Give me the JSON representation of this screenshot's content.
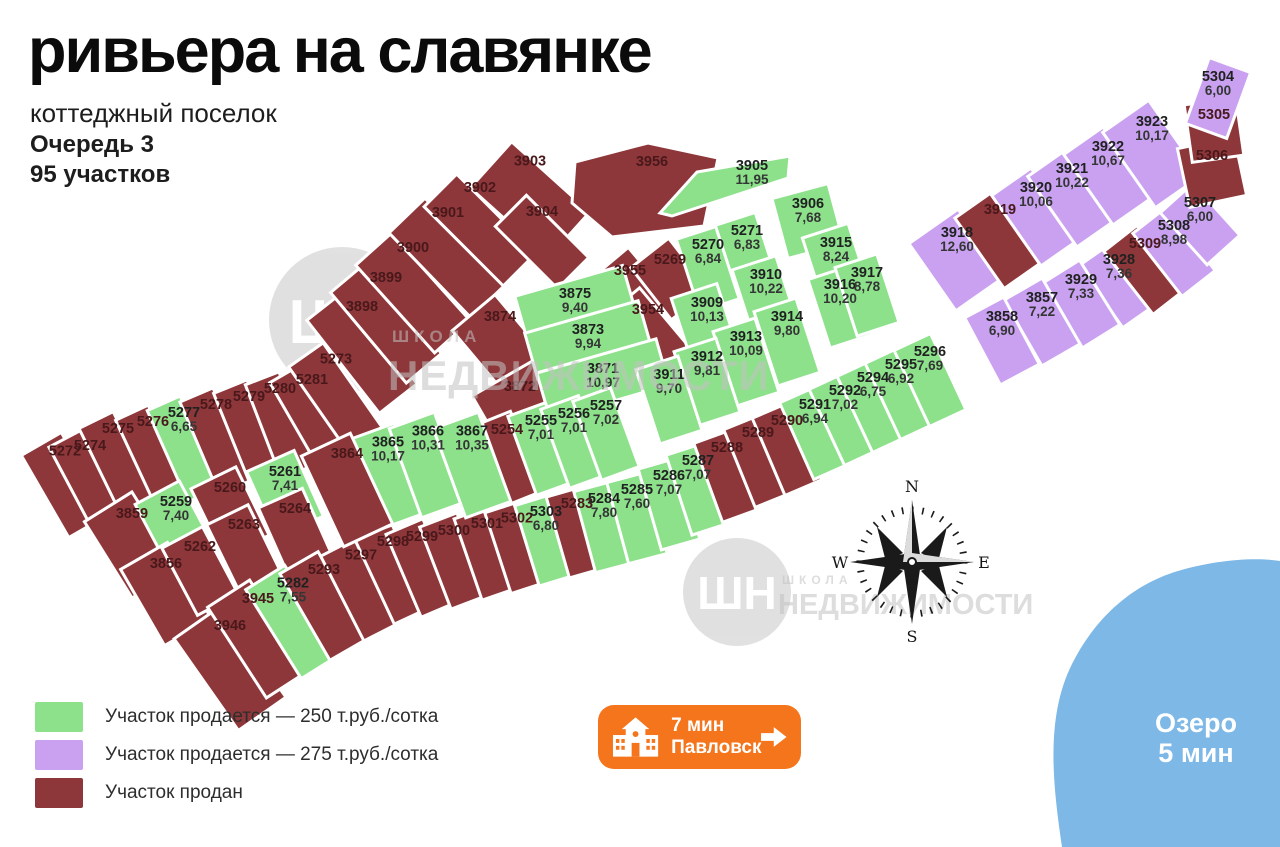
{
  "header": {
    "title": "ривьера на славянке",
    "subtitle": "коттеджный поселок",
    "phase": "Очередь 3",
    "plots_count": "95 участков"
  },
  "legend": {
    "items": [
      {
        "label": "Участок продается — 250 т.руб./сотка",
        "color": "#8de18b",
        "status_key": "g"
      },
      {
        "label": "Участок продается — 275 т.руб./сотка",
        "color": "#c9a1f0",
        "status_key": "p"
      },
      {
        "label": "Участок продан",
        "color": "#8e373a",
        "status_key": "r"
      }
    ]
  },
  "badge": {
    "time": "7 мин",
    "place": "Павловск"
  },
  "lake": {
    "line1": "Озеро",
    "line2": "5 мин",
    "color": "#7db8e7"
  },
  "compass": {
    "n": "N",
    "w": "W",
    "e": "E",
    "s": "S"
  },
  "watermark": {
    "logo": "ШН",
    "small": "ШКОЛА",
    "big": "НЕДВИЖИМОСТИ"
  },
  "map": {
    "status_colors": {
      "g": "#8de18b",
      "p": "#c9a1f0",
      "r": "#8e373a"
    },
    "plots": [
      {
        "id": "3898",
        "st": "r",
        "cx": 362,
        "cy": 352,
        "w": 48,
        "h": 118,
        "r": -38
      },
      {
        "id": "3899",
        "st": "r",
        "cx": 386,
        "cy": 323,
        "w": 46,
        "h": 118,
        "r": -40
      },
      {
        "id": "3900",
        "st": "r",
        "cx": 413,
        "cy": 293,
        "w": 48,
        "h": 118,
        "r": -42
      },
      {
        "id": "3901",
        "st": "r",
        "cx": 448,
        "cy": 258,
        "w": 50,
        "h": 118,
        "r": -44
      },
      {
        "id": "3902",
        "st": "r",
        "cx": 480,
        "cy": 230,
        "w": 46,
        "h": 112,
        "r": -45
      },
      {
        "id": "3903",
        "st": "r",
        "cx": 530,
        "cy": 200,
        "w": 62,
        "h": 105,
        "r": -48
      },
      {
        "id": "3904",
        "st": "r",
        "cx": 542,
        "cy": 242,
        "w": 44,
        "h": 88,
        "r": -45
      },
      {
        "id": "5272",
        "st": "r",
        "cx": 65,
        "cy": 485,
        "w": 46,
        "h": 95,
        "r": -30
      },
      {
        "id": "5274",
        "st": "r",
        "cx": 90,
        "cy": 482,
        "w": 40,
        "h": 100,
        "r": -28
      },
      {
        "id": "5275",
        "st": "r",
        "cx": 118,
        "cy": 465,
        "w": 38,
        "h": 100,
        "r": -26
      },
      {
        "id": "5276",
        "st": "r",
        "cx": 153,
        "cy": 458,
        "w": 36,
        "h": 100,
        "r": -25
      },
      {
        "id": "5277",
        "st": "g",
        "area": "6,65",
        "cx": 184,
        "cy": 449,
        "w": 36,
        "h": 100,
        "r": -24
      },
      {
        "id": "5278",
        "st": "r",
        "cx": 216,
        "cy": 441,
        "w": 36,
        "h": 100,
        "r": -23
      },
      {
        "id": "5279",
        "st": "r",
        "cx": 249,
        "cy": 433,
        "w": 36,
        "h": 100,
        "r": -22
      },
      {
        "id": "5280",
        "st": "r",
        "cx": 280,
        "cy": 425,
        "w": 36,
        "h": 100,
        "r": -21
      },
      {
        "id": "5281",
        "st": "r",
        "cx": 312,
        "cy": 416,
        "w": 40,
        "h": 100,
        "r": -30
      },
      {
        "id": "5273",
        "st": "r",
        "cx": 336,
        "cy": 398,
        "w": 42,
        "h": 105,
        "r": -35
      },
      {
        "id": "3859",
        "st": "r",
        "cx": 132,
        "cy": 545,
        "w": 56,
        "h": 90,
        "r": -32
      },
      {
        "id": "5259",
        "st": "g",
        "area": "7,40",
        "cx": 176,
        "cy": 528,
        "w": 50,
        "h": 80,
        "r": -28
      },
      {
        "id": "5260",
        "st": "r",
        "cx": 230,
        "cy": 512,
        "w": 50,
        "h": 76,
        "r": -26
      },
      {
        "id": "5261",
        "st": "g",
        "area": "7,41",
        "cx": 285,
        "cy": 494,
        "w": 52,
        "h": 72,
        "r": -24
      },
      {
        "id": "3856",
        "st": "r",
        "cx": 166,
        "cy": 594,
        "w": 54,
        "h": 88,
        "r": -30
      },
      {
        "id": "5262",
        "st": "r",
        "cx": 200,
        "cy": 571,
        "w": 46,
        "h": 76,
        "r": -28
      },
      {
        "id": "5263",
        "st": "r",
        "cx": 244,
        "cy": 549,
        "w": 46,
        "h": 76,
        "r": -26
      },
      {
        "id": "5264",
        "st": "r",
        "cx": 295,
        "cy": 531,
        "w": 48,
        "h": 72,
        "r": -24
      },
      {
        "id": "3946",
        "st": "r",
        "cx": 230,
        "cy": 668,
        "w": 58,
        "h": 112,
        "r": -35
      },
      {
        "id": "3945",
        "st": "r",
        "cx": 258,
        "cy": 639,
        "w": 50,
        "h": 108,
        "r": -33
      },
      {
        "id": "5282",
        "st": "g",
        "area": "7,55",
        "cx": 293,
        "cy": 622,
        "w": 46,
        "h": 105,
        "r": -32
      },
      {
        "id": "5293",
        "st": "r",
        "cx": 324,
        "cy": 606,
        "w": 44,
        "h": 100,
        "r": -30
      },
      {
        "id": "5297",
        "st": "r",
        "cx": 361,
        "cy": 589,
        "w": 42,
        "h": 95,
        "r": -27
      },
      {
        "id": "5298",
        "st": "r",
        "cx": 393,
        "cy": 574,
        "w": 40,
        "h": 92,
        "r": -25
      },
      {
        "id": "5299",
        "st": "r",
        "cx": 422,
        "cy": 568,
        "w": 40,
        "h": 90,
        "r": -23
      },
      {
        "id": "5300",
        "st": "r",
        "cx": 454,
        "cy": 561,
        "w": 40,
        "h": 88,
        "r": -21
      },
      {
        "id": "5301",
        "st": "r",
        "cx": 487,
        "cy": 553,
        "w": 40,
        "h": 86,
        "r": -19
      },
      {
        "id": "5302",
        "st": "r",
        "cx": 517,
        "cy": 547,
        "w": 40,
        "h": 85,
        "r": -18
      },
      {
        "id": "5303",
        "st": "g",
        "area": "6,80",
        "cx": 546,
        "cy": 540,
        "w": 40,
        "h": 84,
        "r": -17
      },
      {
        "id": "5283",
        "st": "r",
        "cx": 577,
        "cy": 532,
        "w": 40,
        "h": 84,
        "r": -16
      },
      {
        "id": "5284",
        "st": "g",
        "area": "7,80",
        "cx": 604,
        "cy": 527,
        "w": 40,
        "h": 84,
        "r": -15
      },
      {
        "id": "5285",
        "st": "g",
        "area": "7,60",
        "cx": 637,
        "cy": 518,
        "w": 40,
        "h": 84,
        "r": -15
      },
      {
        "id": "5286",
        "st": "g",
        "area": "7,07",
        "cx": 669,
        "cy": 504,
        "w": 40,
        "h": 84,
        "r": -16
      },
      {
        "id": "5287",
        "st": "g",
        "area": "7,07",
        "cx": 698,
        "cy": 489,
        "w": 40,
        "h": 84,
        "r": -18
      },
      {
        "id": "5288",
        "st": "r",
        "cx": 727,
        "cy": 476,
        "w": 40,
        "h": 84,
        "r": -20
      },
      {
        "id": "5289",
        "st": "r",
        "cx": 758,
        "cy": 461,
        "w": 40,
        "h": 84,
        "r": -22
      },
      {
        "id": "5290",
        "st": "r",
        "cx": 787,
        "cy": 449,
        "w": 40,
        "h": 84,
        "r": -23
      },
      {
        "id": "5291",
        "st": "g",
        "area": "6,94",
        "cx": 815,
        "cy": 433,
        "w": 40,
        "h": 84,
        "r": -24
      },
      {
        "id": "5292",
        "st": "g",
        "area": "7,02",
        "cx": 845,
        "cy": 419,
        "w": 40,
        "h": 84,
        "r": -25
      },
      {
        "id": "5294",
        "st": "g",
        "area": "6,75",
        "cx": 873,
        "cy": 406,
        "w": 40,
        "h": 84,
        "r": -25
      },
      {
        "id": "5295",
        "st": "g",
        "area": "6,92",
        "cx": 901,
        "cy": 393,
        "w": 40,
        "h": 84,
        "r": -25
      },
      {
        "id": "5296",
        "st": "g",
        "area": "7,69",
        "cx": 930,
        "cy": 380,
        "w": 40,
        "h": 84,
        "r": -25
      },
      {
        "id": "3956",
        "st": "r",
        "pts": "575,162 648,143 718,158 704,226 612,237 572,203",
        "lx": 652,
        "ly": 166
      },
      {
        "id": "3955",
        "st": "r",
        "cx": 630,
        "cy": 293,
        "w": 56,
        "h": 72,
        "r": -40
      },
      {
        "id": "5269",
        "st": "r",
        "cx": 670,
        "cy": 279,
        "w": 48,
        "h": 66,
        "r": -38
      },
      {
        "id": "3954",
        "st": "r",
        "cx": 648,
        "cy": 346,
        "w": 62,
        "h": 100,
        "r": -40
      },
      {
        "id": "3874",
        "st": "r",
        "cx": 500,
        "cy": 344,
        "w": 56,
        "h": 82,
        "r": -40
      },
      {
        "id": "3872",
        "st": "r",
        "cx": 520,
        "cy": 404,
        "w": 75,
        "h": 62,
        "r": -30
      },
      {
        "id": "5254",
        "st": "r",
        "cx": 507,
        "cy": 459,
        "w": 42,
        "h": 86,
        "r": -22
      },
      {
        "id": "3875",
        "st": "g",
        "area": "9,40",
        "cx": 575,
        "cy": 303,
        "w": 112,
        "h": 46,
        "r": -16
      },
      {
        "id": "3873",
        "st": "g",
        "area": "9,94",
        "cx": 588,
        "cy": 340,
        "w": 118,
        "h": 48,
        "r": -16
      },
      {
        "id": "3871",
        "st": "g",
        "area": "10,97",
        "cx": 603,
        "cy": 379,
        "w": 124,
        "h": 48,
        "r": -16
      },
      {
        "id": "3865",
        "st": "g",
        "area": "10,17",
        "cx": 388,
        "cy": 476,
        "w": 48,
        "h": 95,
        "r": -20
      },
      {
        "id": "3866",
        "st": "g",
        "area": "10,31",
        "cx": 428,
        "cy": 465,
        "w": 48,
        "h": 95,
        "r": -20
      },
      {
        "id": "3867",
        "st": "g",
        "area": "10,35",
        "cx": 472,
        "cy": 465,
        "w": 48,
        "h": 95,
        "r": -20
      },
      {
        "id": "3864",
        "st": "r",
        "cx": 347,
        "cy": 490,
        "w": 54,
        "h": 100,
        "r": -25
      },
      {
        "id": "5255",
        "st": "g",
        "area": "7,01",
        "cx": 541,
        "cy": 449,
        "w": 40,
        "h": 84,
        "r": -20
      },
      {
        "id": "5256",
        "st": "g",
        "area": "7,01",
        "cx": 574,
        "cy": 442,
        "w": 40,
        "h": 84,
        "r": -20
      },
      {
        "id": "5257",
        "st": "g",
        "area": "7,02",
        "cx": 606,
        "cy": 434,
        "w": 40,
        "h": 84,
        "r": -20
      },
      {
        "id": "3905",
        "st": "g",
        "area": "11,95",
        "pts": "660,213 697,172 790,156 788,178 672,216",
        "lx": 752,
        "ly": 170
      },
      {
        "id": "3906",
        "st": "g",
        "area": "7,68",
        "cx": 808,
        "cy": 221,
        "w": 58,
        "h": 62,
        "r": -15
      },
      {
        "id": "5270",
        "st": "g",
        "area": "6,84",
        "cx": 708,
        "cy": 269,
        "w": 42,
        "h": 76,
        "r": -18
      },
      {
        "id": "5271",
        "st": "g",
        "area": "6,83",
        "cx": 747,
        "cy": 255,
        "w": 42,
        "h": 76,
        "r": -18
      },
      {
        "id": "3915",
        "st": "g",
        "area": "8,24",
        "cx": 836,
        "cy": 264,
        "w": 48,
        "h": 70,
        "r": -18
      },
      {
        "id": "3910",
        "st": "g",
        "area": "10,22",
        "cx": 766,
        "cy": 300,
        "w": 46,
        "h": 78,
        "r": -18
      },
      {
        "id": "3916",
        "st": "g",
        "area": "10,20",
        "cx": 840,
        "cy": 307,
        "w": 44,
        "h": 72,
        "r": -18
      },
      {
        "id": "3917",
        "st": "g",
        "area": "8,78",
        "cx": 867,
        "cy": 295,
        "w": 44,
        "h": 72,
        "r": -18
      },
      {
        "id": "3909",
        "st": "g",
        "area": "10,13",
        "cx": 707,
        "cy": 331,
        "w": 48,
        "h": 84,
        "r": -18
      },
      {
        "id": "3914",
        "st": "g",
        "area": "9,80",
        "cx": 787,
        "cy": 342,
        "w": 44,
        "h": 78,
        "r": -18
      },
      {
        "id": "3913",
        "st": "g",
        "area": "10,09",
        "cx": 746,
        "cy": 362,
        "w": 44,
        "h": 78,
        "r": -18
      },
      {
        "id": "3912",
        "st": "g",
        "area": "9,81",
        "cx": 707,
        "cy": 382,
        "w": 44,
        "h": 78,
        "r": -18
      },
      {
        "id": "3911",
        "st": "g",
        "area": "9,70",
        "cx": 669,
        "cy": 400,
        "w": 44,
        "h": 78,
        "r": -18
      },
      {
        "id": "3918",
        "st": "p",
        "area": "12,60",
        "cx": 957,
        "cy": 260,
        "w": 60,
        "h": 82,
        "r": -35
      },
      {
        "id": "3919",
        "st": "r",
        "cx": 1000,
        "cy": 239,
        "w": 50,
        "h": 86,
        "r": -35
      },
      {
        "id": "3920",
        "st": "p",
        "area": "10,06",
        "cx": 1036,
        "cy": 217,
        "w": 48,
        "h": 86,
        "r": -35
      },
      {
        "id": "3921",
        "st": "p",
        "area": "10,22",
        "cx": 1072,
        "cy": 198,
        "w": 48,
        "h": 86,
        "r": -35
      },
      {
        "id": "3922",
        "st": "p",
        "area": "10,67",
        "cx": 1108,
        "cy": 176,
        "w": 48,
        "h": 86,
        "r": -35
      },
      {
        "id": "3923",
        "st": "p",
        "area": "10,17",
        "cx": 1152,
        "cy": 154,
        "w": 56,
        "h": 92,
        "r": -35
      },
      {
        "id": "3928",
        "st": "p",
        "area": "7,36",
        "cx": 1119,
        "cy": 284,
        "w": 44,
        "h": 76,
        "r": -35
      },
      {
        "id": "3929",
        "st": "p",
        "area": "7,33",
        "cx": 1081,
        "cy": 304,
        "w": 44,
        "h": 76,
        "r": -32
      },
      {
        "id": "3857",
        "st": "p",
        "area": "7,22",
        "cx": 1042,
        "cy": 322,
        "w": 44,
        "h": 76,
        "r": -30
      },
      {
        "id": "3858",
        "st": "p",
        "area": "6,90",
        "cx": 1002,
        "cy": 341,
        "w": 44,
        "h": 76,
        "r": -28
      },
      {
        "id": "5309",
        "st": "r",
        "cx": 1145,
        "cy": 270,
        "w": 42,
        "h": 80,
        "r": -38
      },
      {
        "id": "5308",
        "st": "p",
        "area": "8,98",
        "cx": 1174,
        "cy": 252,
        "w": 42,
        "h": 80,
        "r": -38
      },
      {
        "id": "5307",
        "st": "p",
        "area": "6,00",
        "cx": 1200,
        "cy": 224,
        "w": 44,
        "h": 70,
        "r": -42
      },
      {
        "id": "5306",
        "st": "r",
        "cx": 1212,
        "cy": 172,
        "w": 58,
        "h": 60,
        "r": -12
      },
      {
        "id": "5305",
        "st": "r",
        "cx": 1214,
        "cy": 130,
        "w": 52,
        "h": 58,
        "r": -8
      },
      {
        "id": "5304",
        "st": "p",
        "area": "6,00",
        "cx": 1218,
        "cy": 98,
        "w": 44,
        "h": 70,
        "r": 20
      }
    ]
  }
}
